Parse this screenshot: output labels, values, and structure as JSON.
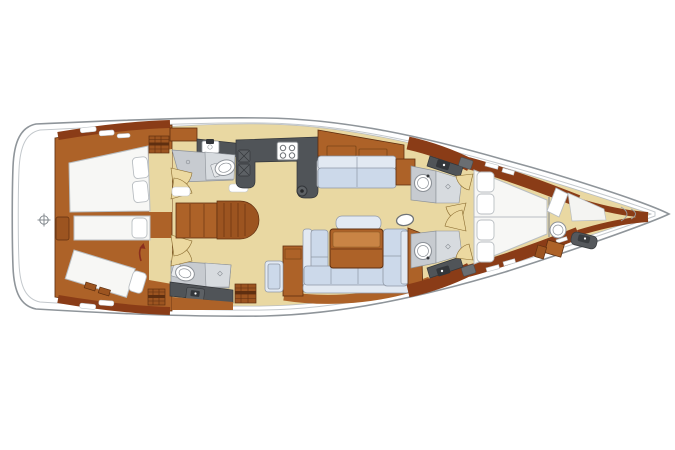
{
  "page": {
    "background": "#ffffff"
  },
  "diagram": {
    "type": "sailboat-interior-floor-plan",
    "orientation": "bow-right-stern-left",
    "features": [
      "swim-platform",
      "twin-aft-cabins-with-berths",
      "twin-aft-heads-with-toilet-and-sink",
      "companionway-steps",
      "galley-with-double-sink-and-stove",
      "mast-post",
      "upper-settee",
      "u-shaped-salon-sofa-with-table",
      "oval-side-table",
      "twin-forward-heads-with-washbasin-and-shower",
      "forward-owner-cabin-island-berth",
      "forepeak-crew-area-with-basin",
      "anchor-locker"
    ],
    "colors": {
      "hull_stroke": "#8f959a",
      "inner_line": "#c3c8cc",
      "floor": "#e9d8a2",
      "wood": "#ad6228",
      "wood_dark": "#8a3c17",
      "wood_edge": "#5f2f10",
      "wood_step": "#9c5420",
      "wood_leaf": "#c98445",
      "mattress": "#f7f7f5",
      "mattress_edge": "#b9bec2",
      "cushion": "#ccd9ea",
      "cushion_light": "#e2e9f2",
      "cushion_edge": "#8f98a6",
      "wet_floor": "#c7cbd0",
      "wet_light": "#d7dbdf",
      "wet_edge": "#8d9298",
      "counter": "#505458",
      "counter_dark": "#33363a",
      "appliance": "#5d6165",
      "door": "#ecd9a0",
      "door_edge": "#8a6b2f",
      "arrow_red": "#8a2f1e",
      "white": "#ffffff"
    }
  }
}
